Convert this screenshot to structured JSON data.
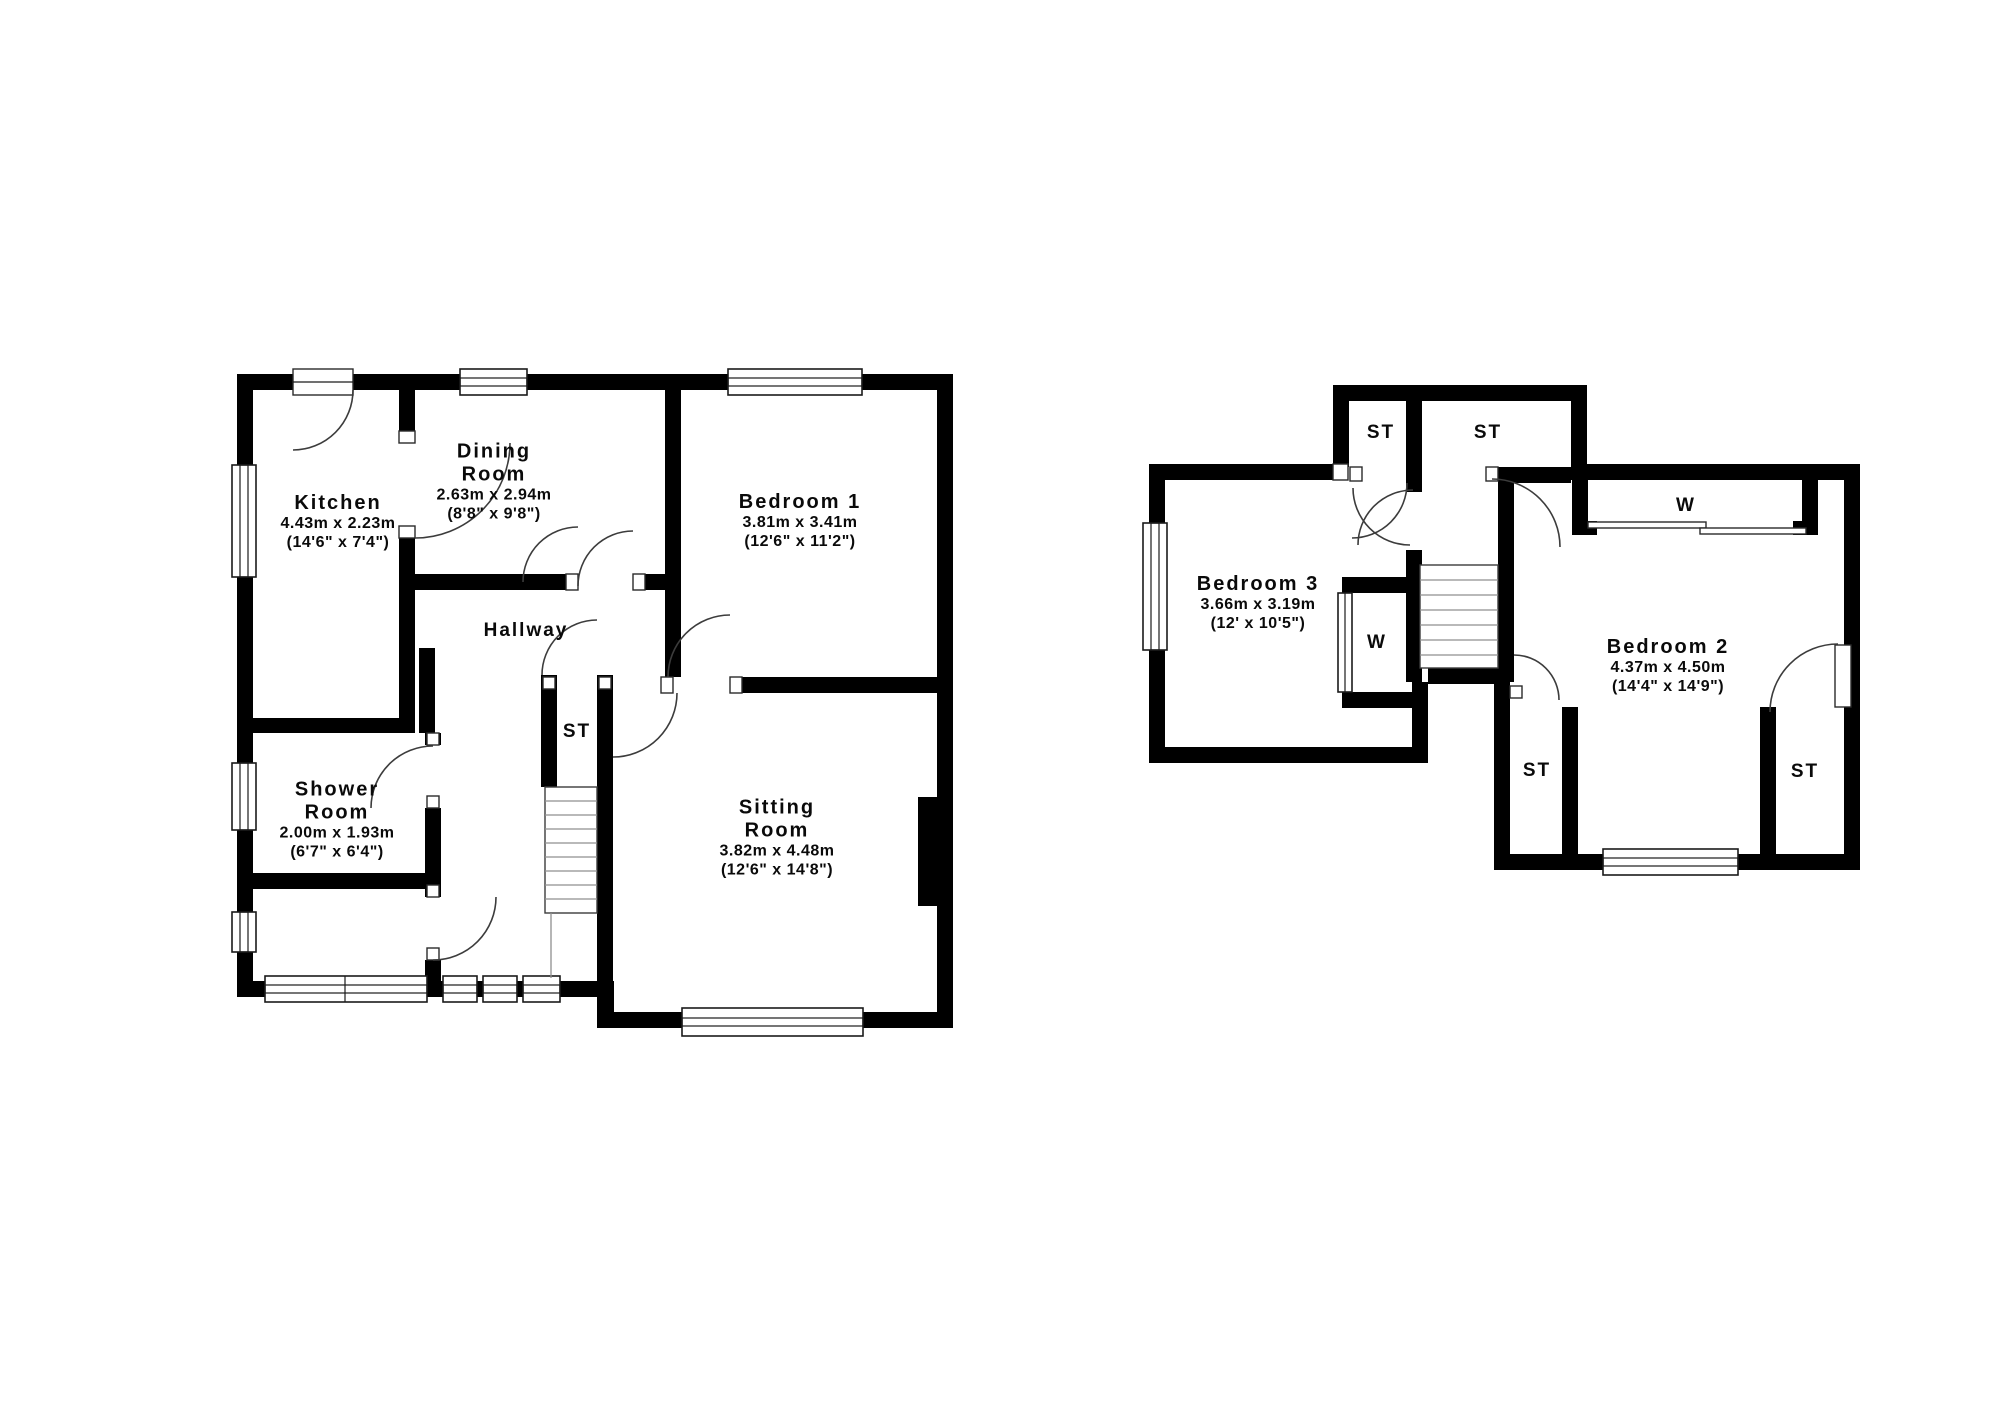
{
  "colors": {
    "wall": "#000000",
    "background": "#ffffff",
    "door_line": "#3c3c3c"
  },
  "ground_floor": {
    "rooms": {
      "kitchen": {
        "name": "Kitchen",
        "metric": "4.43m x 2.23m",
        "imperial": "(14'6\" x 7'4\")"
      },
      "dining": {
        "name_line1": "Dining",
        "name_line2": "Room",
        "metric": "2.63m x 2.94m",
        "imperial": "(8'8\" x 9'8\")"
      },
      "bedroom1": {
        "name": "Bedroom 1",
        "metric": "3.81m x 3.41m",
        "imperial": "(12'6\" x 11'2\")"
      },
      "sitting": {
        "name_line1": "Sitting",
        "name_line2": "Room",
        "metric": "3.82m x 4.48m",
        "imperial": "(12'6\" x 14'8\")"
      },
      "shower": {
        "name_line1": "Shower",
        "name_line2": "Room",
        "metric": "2.00m x 1.93m",
        "imperial": "(6'7\" x 6'4\")"
      },
      "hallway": {
        "name": "Hallway"
      },
      "storage": {
        "name": "ST"
      }
    }
  },
  "first_floor": {
    "rooms": {
      "bedroom3": {
        "name": "Bedroom 3",
        "metric": "3.66m x 3.19m",
        "imperial": "(12' x 10'5\")"
      },
      "bedroom2": {
        "name": "Bedroom 2",
        "metric": "4.37m x 4.50m",
        "imperial": "(14'4\" x 14'9\")"
      },
      "storage_top_left": {
        "name": "ST"
      },
      "storage_top_right": {
        "name": "ST"
      },
      "storage_bottom_left": {
        "name": "ST"
      },
      "storage_bottom_right": {
        "name": "ST"
      },
      "wardrobe_left": {
        "name": "W"
      },
      "wardrobe_top": {
        "name": "W"
      }
    }
  }
}
